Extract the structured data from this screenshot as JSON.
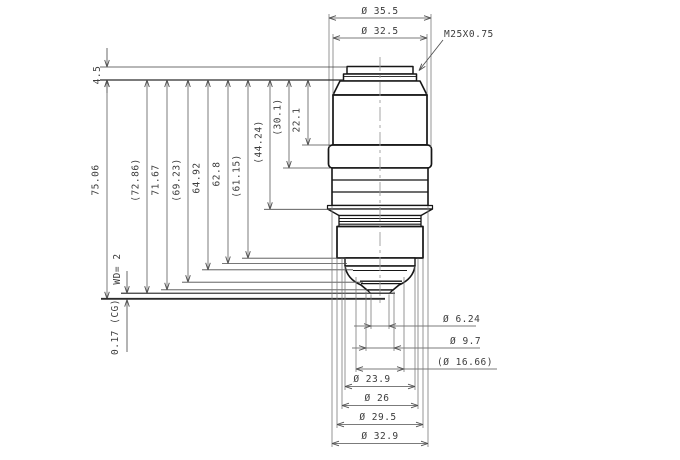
{
  "colors": {
    "body": "#161616",
    "dim_line": "#4f4f4f",
    "ext_line": "#7a7a7a",
    "centerline": "#9c9c9c",
    "text": "#3c3c3c",
    "background": "#ffffff"
  },
  "thread_callout": {
    "label": "M25X0.75",
    "text_x": 444,
    "text_y": 37,
    "leader": [
      [
        443,
        40
      ],
      [
        419,
        70.5
      ]
    ],
    "arrow_legs": [
      [
        425.3,
        66.4
      ],
      [
        421.8,
        63.7
      ]
    ]
  },
  "top_dims": [
    {
      "label": "Ø 35.5",
      "y": 18,
      "x1": 329,
      "x2": 431,
      "ext_y2": 147
    },
    {
      "label": "Ø 32.5",
      "y": 38,
      "x1": 333,
      "x2": 427,
      "ext_y2": 94
    }
  ],
  "datum": {
    "label": "4.5",
    "x": 107,
    "text_x": 100,
    "text_y": 75,
    "y_top": 67,
    "y_bottom": 80,
    "line_top_x": [
      100,
      346
    ],
    "line_bottom_x": [
      100,
      343.5
    ],
    "shaft_top_y": 48
  },
  "left_dims": [
    {
      "label": "75.06",
      "x": 107,
      "plane": 298.8,
      "conn": [
        101,
        385
      ],
      "ty": 180
    },
    {
      "label": "(72.86)",
      "x": 147,
      "plane": 293.2,
      "conn": [
        121,
        395
      ],
      "ty": 180
    },
    {
      "label": "71.67",
      "x": 167,
      "plane": 289.8,
      "conn": [
        161,
        368
      ],
      "ty": 180
    },
    {
      "label": "(69.23)",
      "x": 188,
      "plane": 282.2,
      "conn": [
        182,
        363
      ],
      "ty": 180
    },
    {
      "label": "64.92",
      "x": 208,
      "plane": 269.8,
      "conn": [
        202,
        353
      ],
      "ty": 178
    },
    {
      "label": "62.8",
      "x": 228,
      "plane": 263.5,
      "conn": [
        222,
        347
      ],
      "ty": 174
    },
    {
      "label": "(61.15)",
      "x": 248,
      "plane": 258.2,
      "conn": [
        242,
        346
      ],
      "ty": 176
    },
    {
      "label": "(44.24)",
      "x": 270,
      "plane": 209.3,
      "conn": [
        264,
        340
      ],
      "ty": 142
    },
    {
      "label": "(30.1)",
      "x": 289,
      "plane": 168.0,
      "conn": [
        283,
        330
      ],
      "ty": 117
    },
    {
      "label": "22.1",
      "x": 308,
      "plane": 145.0,
      "conn": [
        302,
        330
      ],
      "ty": 120
    }
  ],
  "working_distance": {
    "label": "WD= 2",
    "x": 127,
    "text_x": 120,
    "text_y": 269,
    "tip_y": 293.2,
    "shaft_top_y": 271
  },
  "cover_glass": {
    "label": "0.17 (CG)",
    "x": 127,
    "text_x": 118,
    "text_y": 327,
    "tip_y": 299.6,
    "shaft_bottom_y": 352
  },
  "focal_lines": [
    {
      "y": 293.2,
      "x1": 121,
      "x2": 395,
      "w": 1.0
    },
    {
      "y": 298.8,
      "x1": 101,
      "x2": 385,
      "w": 1.8
    }
  ],
  "bottom_dims": [
    {
      "label": "Ø 6.24",
      "y": 326.0,
      "x1": 371,
      "x2": 389,
      "style": "out",
      "line": [
        354,
        476
      ],
      "tx": 443,
      "ty": 322,
      "anchor": "start",
      "ext_y1": 294.5,
      "ext_y2": 329
    },
    {
      "label": "Ø 9.7",
      "y": 348.0,
      "x1": 366,
      "x2": 394,
      "style": "out",
      "line": [
        352,
        480
      ],
      "tx": 450,
      "ty": 344,
      "anchor": "start",
      "ext_y1": 291.5,
      "ext_y2": 351
    },
    {
      "label": "(Ø 16.66)",
      "y": 369.0,
      "x1": 356,
      "x2": 404,
      "style": "in",
      "line": [
        356,
        497
      ],
      "tx": 437,
      "ty": 365,
      "anchor": "start",
      "ext_y1": 277.0,
      "ext_y2": 372
    },
    {
      "label": "Ø 23.9",
      "y": 386.5,
      "x1": 345,
      "x2": 415,
      "style": "in",
      "line": [
        345,
        415
      ],
      "tx": 372,
      "ty": 382,
      "anchor": "middle",
      "ext_y1": 266.0,
      "ext_y2": 390
    },
    {
      "label": "Ø 26",
      "y": 405.5,
      "x1": 342,
      "x2": 418,
      "style": "in",
      "line": [
        342,
        418
      ],
      "tx": 377,
      "ty": 401,
      "anchor": "middle",
      "ext_y1": 258.5,
      "ext_y2": 409
    },
    {
      "label": "Ø 29.5",
      "y": 424.5,
      "x1": 337,
      "x2": 423,
      "style": "in",
      "line": [
        337,
        423
      ],
      "tx": 378,
      "ty": 420,
      "anchor": "middle",
      "ext_y1": 258.5,
      "ext_y2": 428
    },
    {
      "label": "Ø 32.9",
      "y": 443.5,
      "x1": 332,
      "x2": 428,
      "style": "in",
      "line": [
        332,
        428
      ],
      "tx": 380,
      "ty": 439,
      "anchor": "middle",
      "ext_y1": 206.0,
      "ext_y2": 447
    }
  ],
  "centerline": {
    "x": 380,
    "y1": 57,
    "y2": 306
  }
}
